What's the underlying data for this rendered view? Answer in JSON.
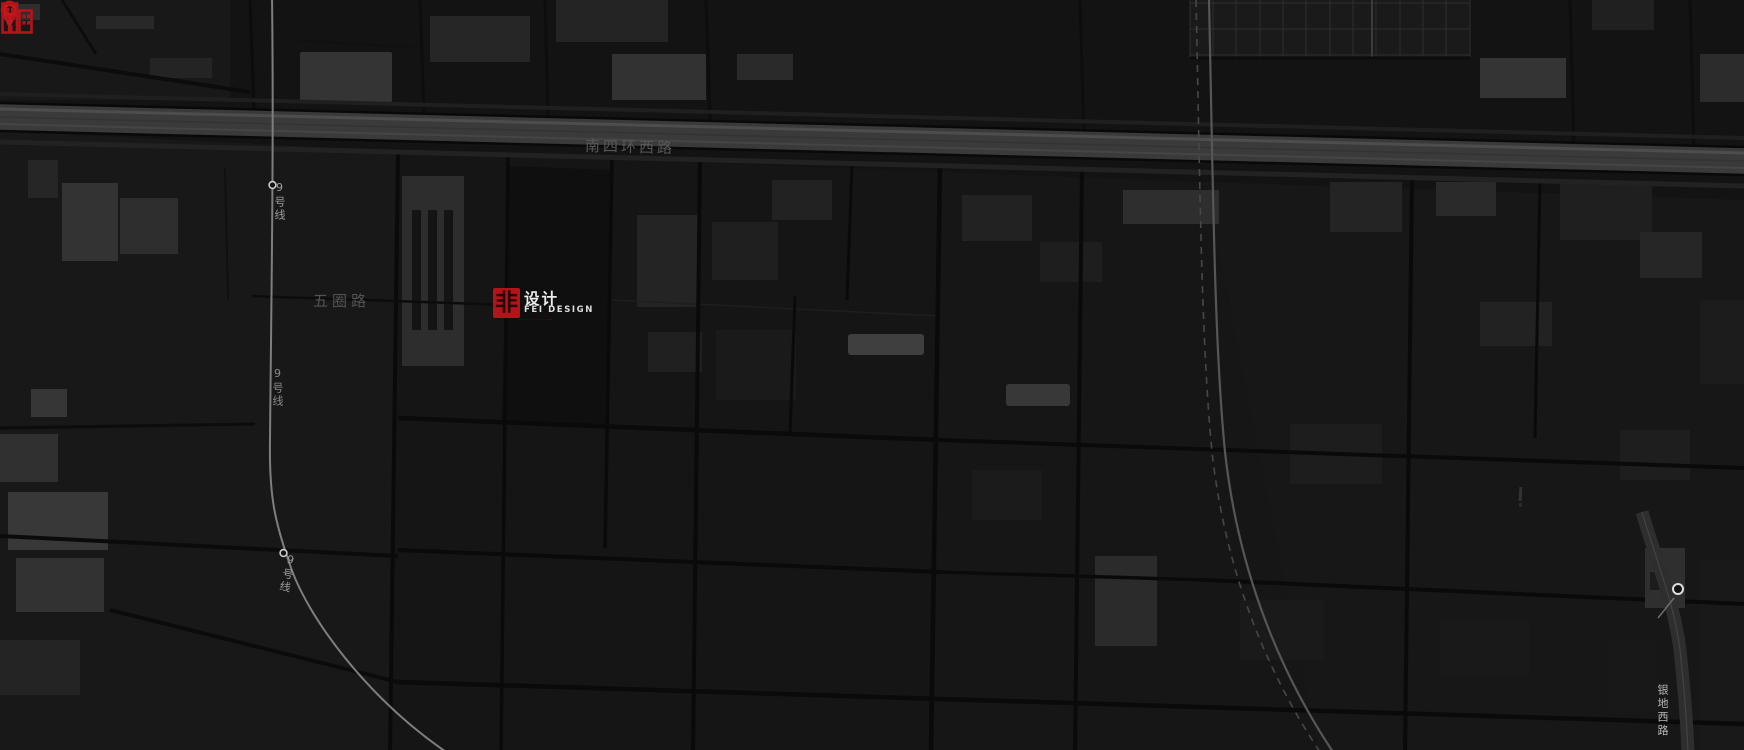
{
  "map": {
    "theme": "dark",
    "background_color": "#131313",
    "road_label_color": "#585858",
    "metro_label_color": "#9c9c9c",
    "labels": {
      "ring_road": "南四环西路",
      "wuquan_road": "五圈路",
      "metro_line9": "9号线",
      "yindi_west_road": "银地西路"
    }
  },
  "marker": {
    "pin_color": "#c4161c",
    "building_icon_color": "#b5131a"
  },
  "logo": {
    "accent_color": "#b5131a",
    "square_char": "非",
    "title": "设计",
    "subtitle": "FEI DESIGN",
    "tagline": "—··········—",
    "text_color": "#ececec"
  }
}
